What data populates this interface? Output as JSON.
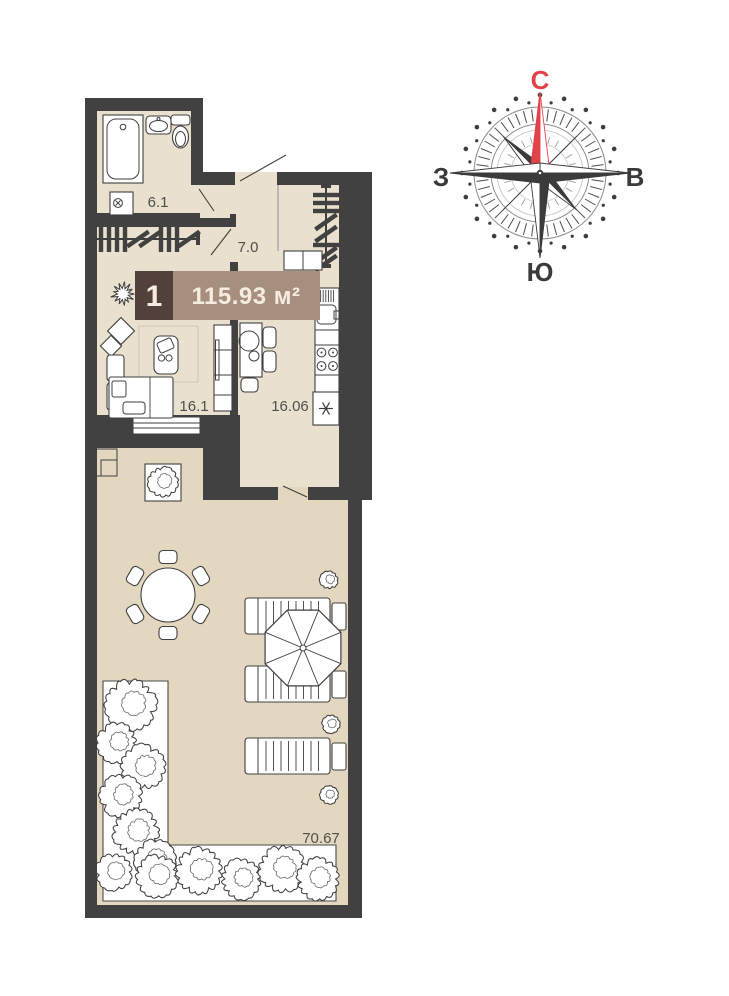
{
  "plan": {
    "badge": {
      "number": "1",
      "area": "115.93 м²"
    },
    "rooms": {
      "bathroom": "6.1",
      "hallway": "7.0",
      "living": "16.1",
      "kitchen": "16.06",
      "terrace": "70.67"
    }
  },
  "compass": {
    "north": "С",
    "east": "В",
    "south": "Ю",
    "west": "З"
  },
  "colors": {
    "wall": "#414141",
    "line": "#3f3f3f",
    "floor": "#e9e0cd",
    "terrace_floor": "#e4d7c0",
    "badge_dark": "#52413a",
    "badge_light": "#a78f80",
    "badge_text": "#f4ecdf",
    "accent_red": "#e2434b",
    "label": "#4f4f4f"
  }
}
